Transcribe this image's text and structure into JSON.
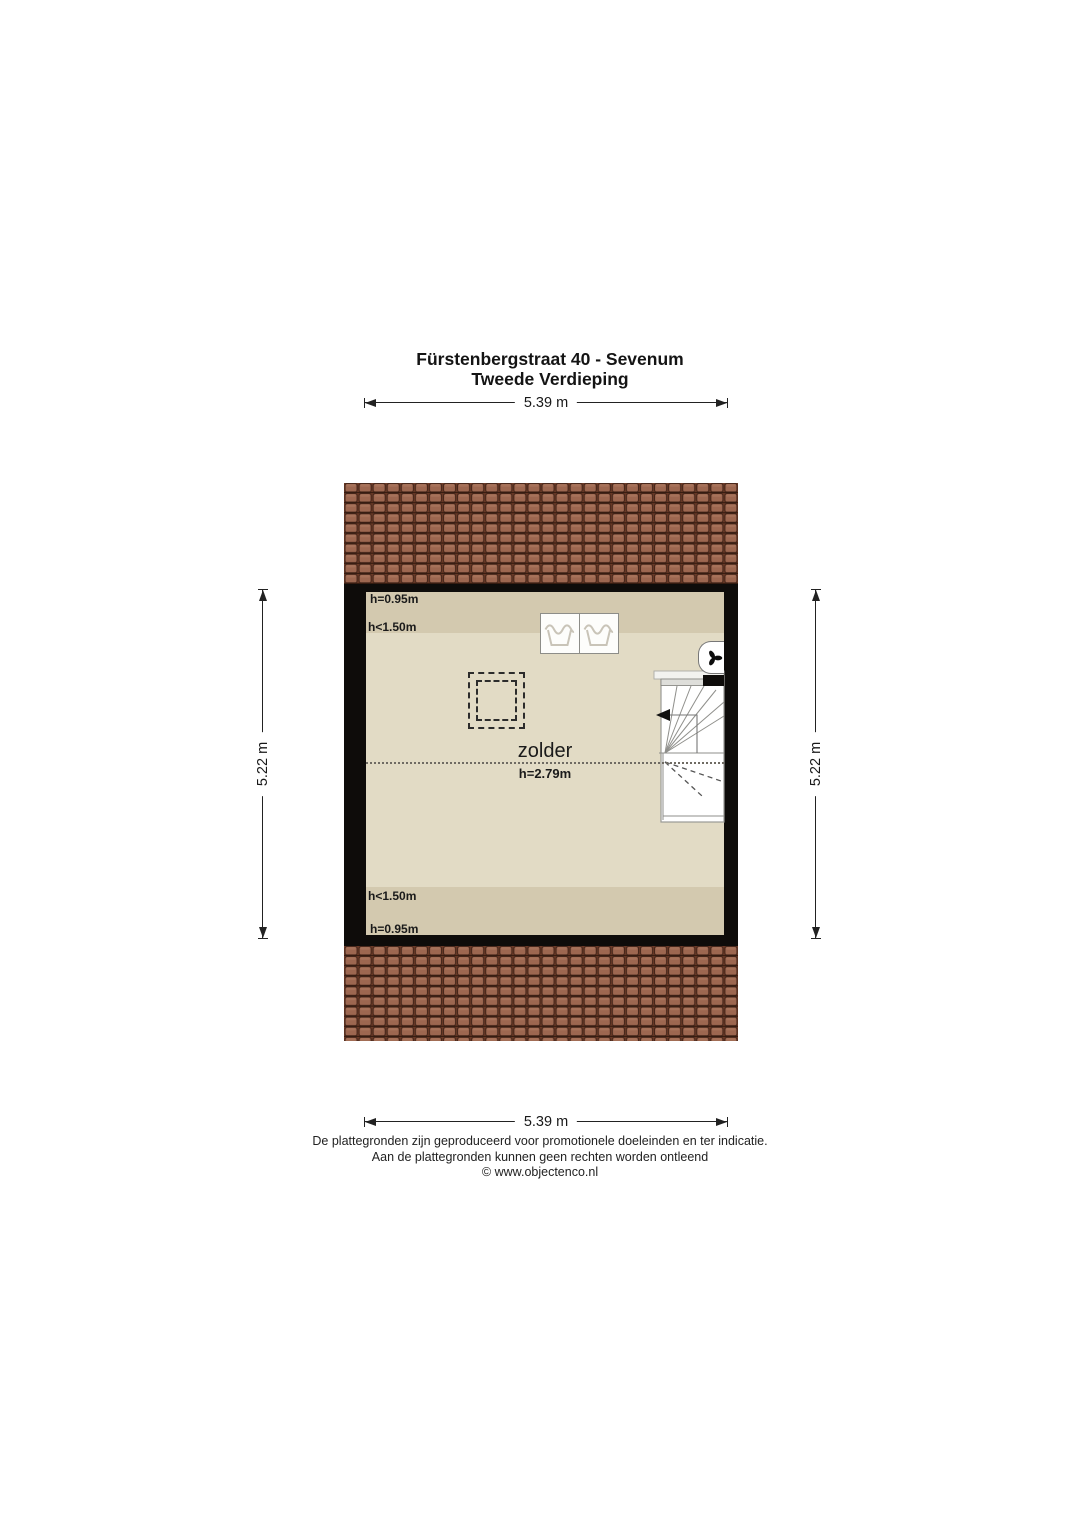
{
  "title": {
    "line1": "Fürstenbergstraat 40 - Sevenum",
    "line2": "Tweede Verdieping"
  },
  "dimensions": {
    "top": "5.39 m",
    "bottom": "5.39 m",
    "left": "5.22 m",
    "right": "5.22 m"
  },
  "room": {
    "name": "zolder",
    "height": "h=2.79m"
  },
  "height_labels": {
    "top_wall": "h=0.95m",
    "top_slope": "h<1.50m",
    "bottom_slope": "h<1.50m",
    "bottom_wall": "h=0.95m"
  },
  "icons": {
    "washer_left": "wash-tub-symbol",
    "washer_right": "wash-tub-symbol",
    "ventilation": "fan-symbol",
    "skylight": "dashed-rect-symbol",
    "staircase": "winder-stairs-with-down-arrow"
  },
  "footer": {
    "line1": "De plattegronden zijn geproduceerd voor promotionele doeleinden en ter indicatie.",
    "line2": "Aan de plattegronden kunnen geen rechten worden ontleend",
    "line3": "© www.objectenco.nl"
  },
  "colors": {
    "roof_tile": "#9d6750",
    "roof_joint": "#3f2115",
    "wall": "#0e0c0a",
    "floor_main": "#e2dbc5",
    "floor_low_zone": "#d3c9af",
    "dimension_line": "#222222"
  }
}
